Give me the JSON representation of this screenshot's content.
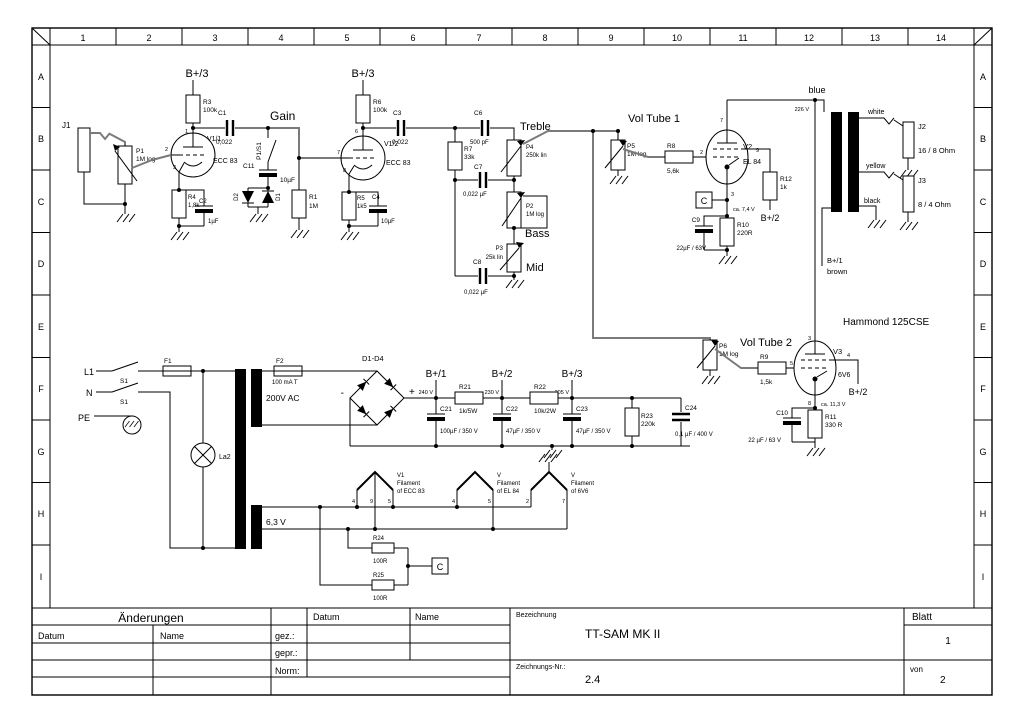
{
  "sheet": {
    "cols": [
      "1",
      "2",
      "3",
      "4",
      "5",
      "6",
      "7",
      "8",
      "9",
      "10",
      "11",
      "12",
      "13",
      "14"
    ],
    "rows": [
      "A",
      "B",
      "C",
      "D",
      "E",
      "F",
      "G",
      "H",
      "I"
    ]
  },
  "title_block": {
    "aenderungen": "Änderungen",
    "datum": "Datum",
    "name": "Name",
    "gez": "gez.:",
    "gepr": "gepr.:",
    "norm": "Norm:",
    "bezeichnung_label": "Bezeichnung",
    "bezeichnung": "TT-SAM MK II",
    "zeichnung_label": "Zeichnungs-Nr.:",
    "zeichnung_nr": "2.4",
    "blatt_label": "Blatt",
    "blatt": "1",
    "von_label": "von",
    "von": "2"
  },
  "labels": {
    "b_plus_1": "B+/1",
    "b_plus_2": "B+/2",
    "b_plus_3": "B+/3",
    "gain": "Gain",
    "treble": "Treble",
    "bass": "Bass",
    "mid": "Mid",
    "vol_tube_1": "Vol Tube 1",
    "vol_tube_2": "Vol Tube 2",
    "hammond": "Hammond 125CSE",
    "j1": "J1",
    "p1": "P1",
    "p1_val": "1M log",
    "v1_1": "V1/1",
    "ecc83": "ECC 83",
    "r3": "R3",
    "r3_val": "100k",
    "c1": "C1",
    "c1_val": "0,022",
    "p1s1": "P1/S1",
    "c11": "C11",
    "c11_val": "10µF",
    "d1": "D1",
    "d2": "D2",
    "r4": "R4",
    "r4_val": "1,8k",
    "c2": "C2",
    "c2_val": "1µF",
    "r1": "R1",
    "r1_val": "1M",
    "r6": "R6",
    "r6_val": "100k",
    "c3": "C3",
    "c3_val": "0,022",
    "v1_2": "V1/2",
    "r5": "R5",
    "r5_val": "1k5",
    "c4": "C4",
    "c4_val": "10µF",
    "c6": "C6",
    "c6_val": "500 pF",
    "r7": "R7",
    "r7_val": "33k",
    "c7": "C7",
    "c7_val": "0,022 µF",
    "c8": "C8",
    "c8_val": "0,022 µF",
    "p4": "P4",
    "p4_val": "250k lin",
    "p2": "P2",
    "p2_val": "1M log",
    "p3": "P3",
    "p3_val": "25k lin",
    "p5": "P5",
    "p5_val": "1M log",
    "r8": "R8",
    "r8_val": "5,6k",
    "v2": "V2",
    "el84": "EL 84",
    "c_node": "C",
    "ca74": "ca. 7,4 V",
    "c9": "C9",
    "c9_val": "22µF / 63V",
    "r10": "R10",
    "r10_val": "220R",
    "r12": "R12",
    "r12_val": "1k",
    "v226": "226 V",
    "blue": "blue",
    "white": "white",
    "yellow": "yellow",
    "black": "black",
    "brown": "brown",
    "j2": "J2",
    "j2_val": "16 / 8 Ohm",
    "j3": "J3",
    "j3_val": "8 / 4 Ohm",
    "p6": "P6",
    "p6_val": "1M log",
    "r9": "R9",
    "r9_val": "1,5k",
    "v3": "V3",
    "v6v6": "6V6",
    "ca113": "ca. 11,3 V",
    "c10": "C10",
    "c10_val": "22 µF / 63 V",
    "r11": "R11",
    "r11_val": "330 R",
    "l1": "L1",
    "n": "N",
    "pe": "PE",
    "s1": "S1",
    "f1": "F1",
    "f2": "F2",
    "f2_val": "100 mA T",
    "v200": "200V AC",
    "la2": "La2",
    "d1d4": "D1-D4",
    "plus": "+",
    "minus": "-",
    "v240": "240 V",
    "v230": "230 V",
    "v205": "205 V",
    "r21": "R21",
    "r21_val": "1k/5W",
    "r22": "R22",
    "r22_val": "10k/2W",
    "c21": "C21",
    "c21_val": "100µF / 350 V",
    "c22": "C22",
    "c22_val": "47µF / 350 V",
    "c23": "C23",
    "c23_val": "47µF / 350 V",
    "r23": "R23",
    "r23_val": "220k",
    "c24": "C24",
    "c24_val": "0,1 µF / 400 V",
    "v63": "6,3 V",
    "v1_fil": "V1",
    "v_fil": "V",
    "fil": "Filament",
    "fil_ecc": "of ECC 83",
    "fil_el84": "of EL 84",
    "fil_6v6": "of 6V6",
    "r24": "R24",
    "r25": "R25",
    "r100": "100R",
    "pin1": "1",
    "pin2": "2",
    "pin3": "3",
    "pin4": "4",
    "pin5": "5",
    "pin6": "6",
    "pin7": "7",
    "pin8": "8",
    "pin9": "9"
  }
}
